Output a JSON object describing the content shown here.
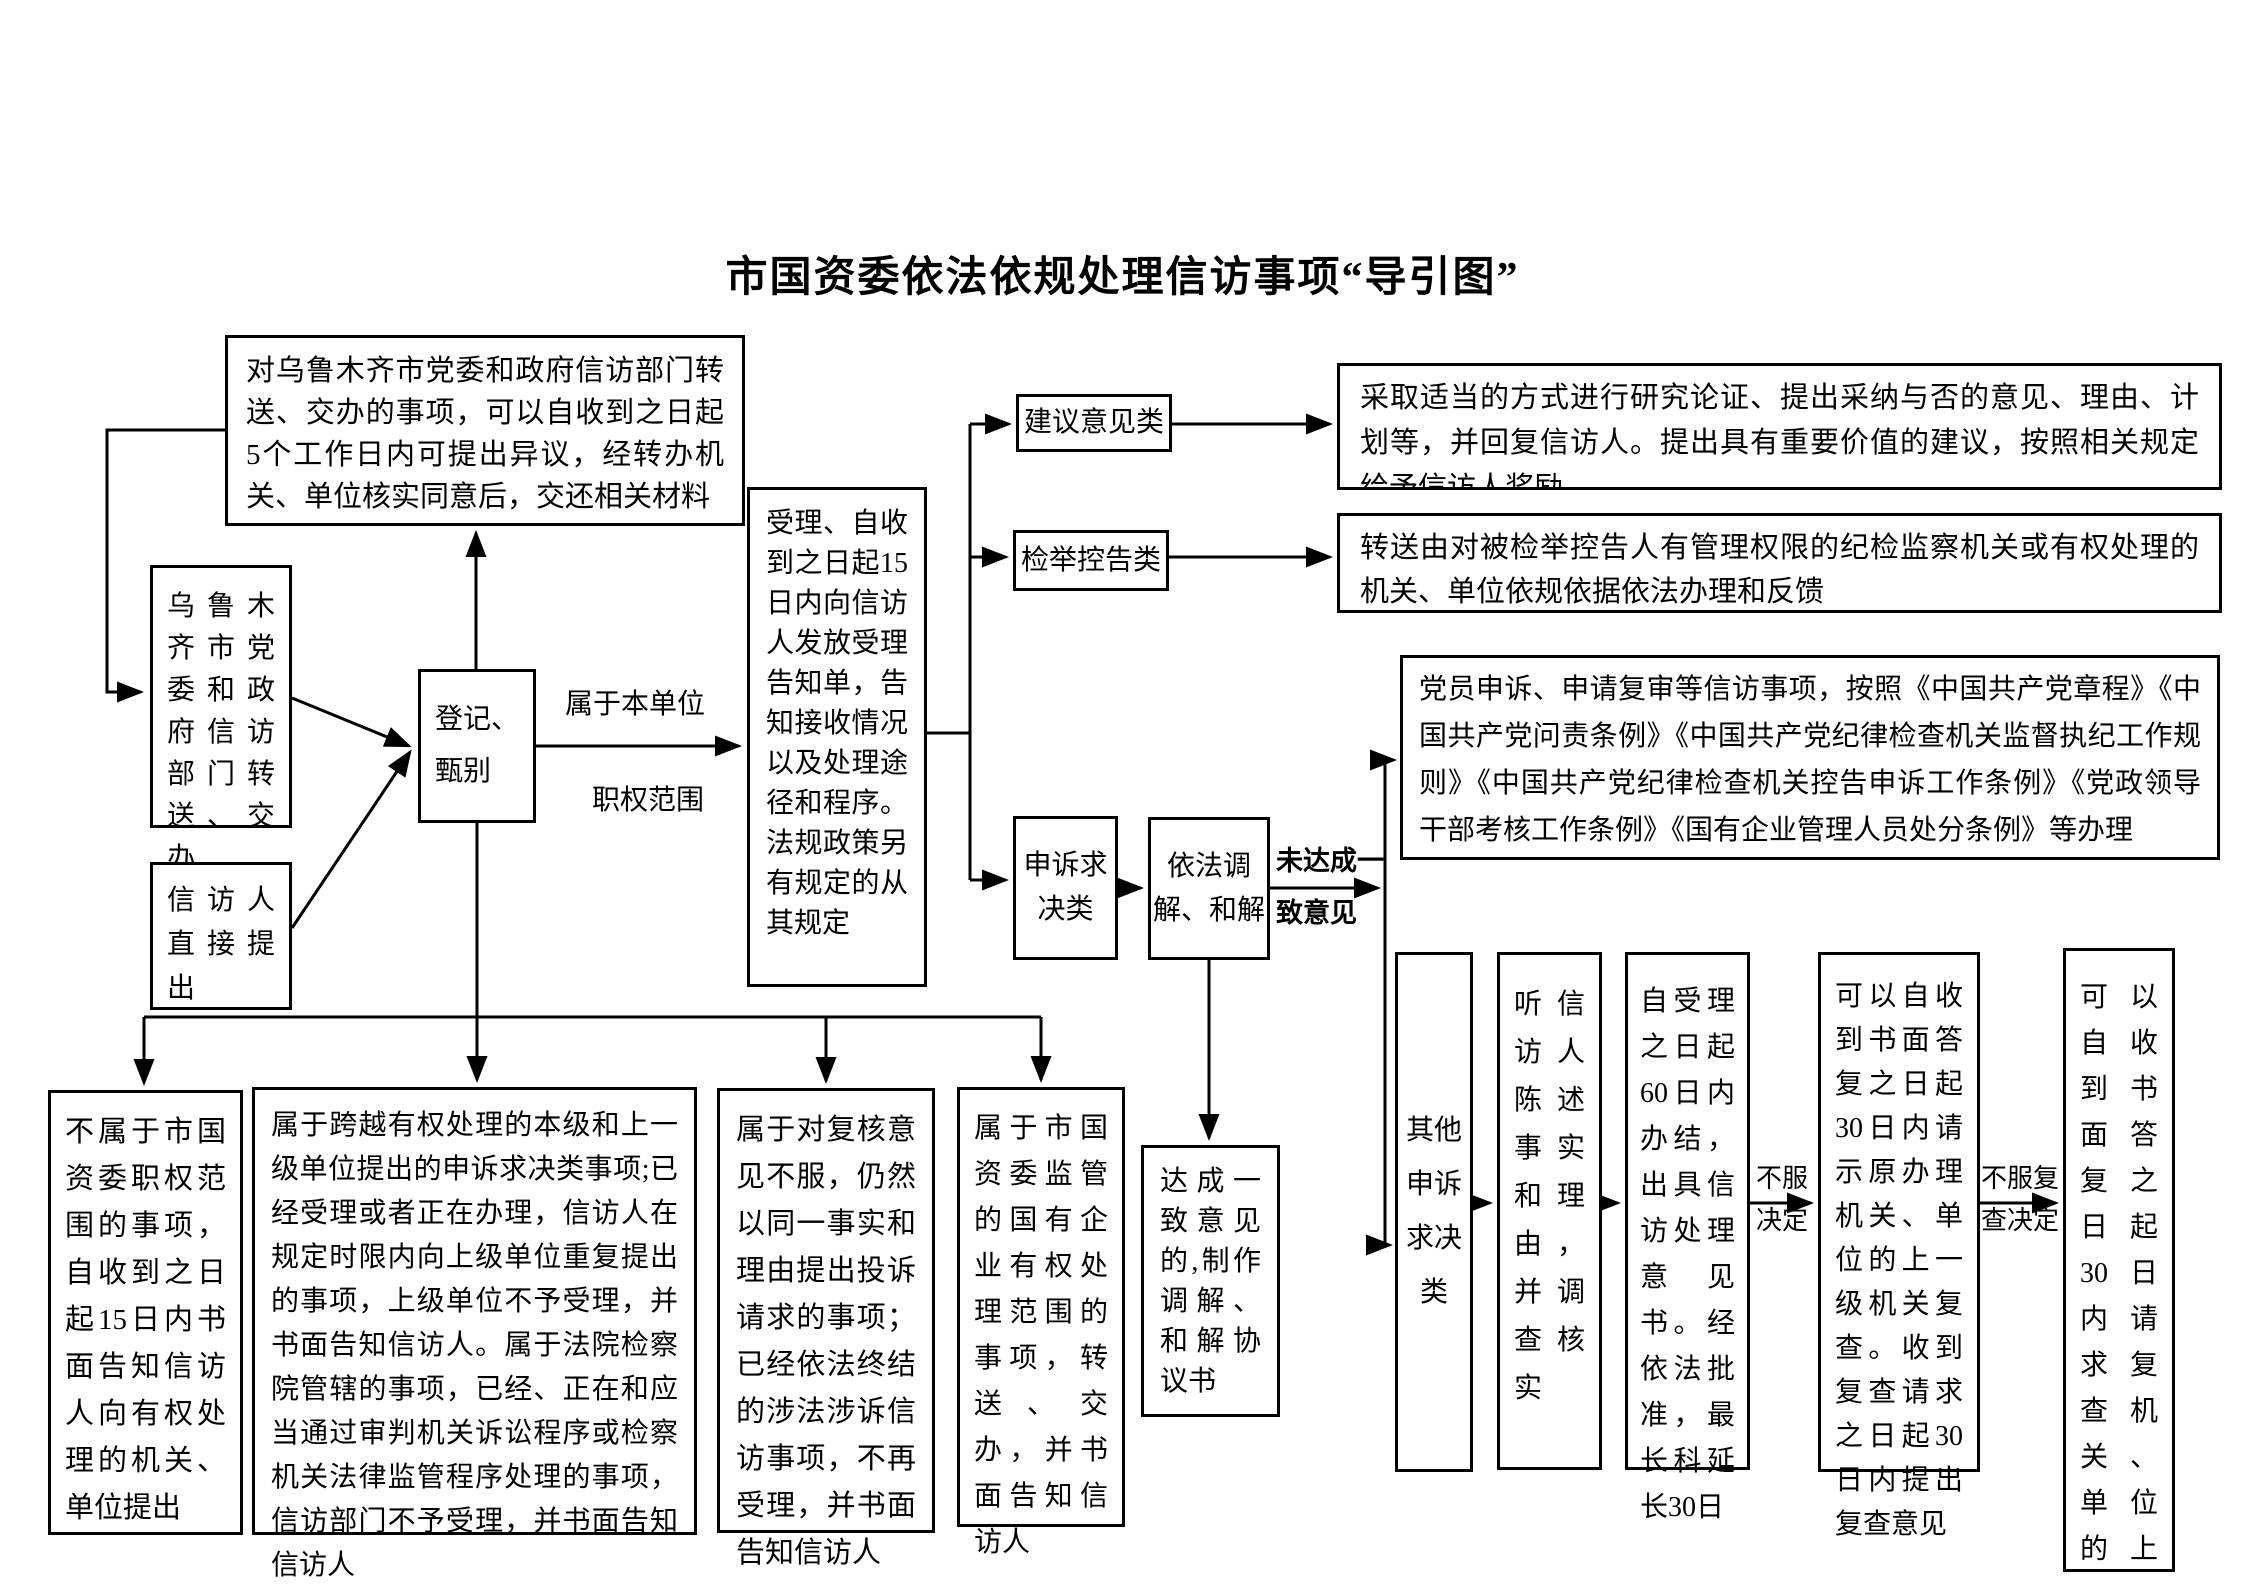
{
  "title": "市国资委依法依规处理信访事项“导引图”",
  "boxes": {
    "objection": {
      "text": "对乌鲁木齐市党委和政府信访部门转送、交办的事项，可以自收到之日起5个工作日内可提出异议，经转办机关、单位核实同意后，交还相关材料"
    },
    "source_gov": {
      "text": "乌鲁木齐市党委和政府信访部门转送、交办"
    },
    "source_direct": {
      "text": "信访人直接提出"
    },
    "register": {
      "text": "登记、甄别"
    },
    "accept": {
      "text": "受理、自收到之日起15日内向信访人发放受理告知单，告知接收情况以及处理途径和程序。法规政策另有规定的从其规定"
    },
    "suggestion": {
      "text": "建议意见类"
    },
    "accusation": {
      "text": "检举控告类"
    },
    "suggestion_handle": {
      "text": "采取适当的方式进行研究论证、提出采纳与否的意见、理由、计划等，并回复信访人。提出具有重要价值的建议，按照相关规定给予信访人奖励"
    },
    "accusation_handle": {
      "text": "转送由对被检举控告人有管理权限的纪检监察机关或有权处理的机关、单位依规依据依法办理和反馈"
    },
    "party_rules": {
      "text": "党员申诉、申请复审等信访事项，按照《中国共产党章程》《中国共产党问责条例》《中国共产党纪律检查机关监督执纪工作规则》《中国共产党纪律检查机关控告申诉工作条例》《党政领导干部考核工作条例》《国有企业管理人员处分条例》等办理"
    },
    "appeal": {
      "text": "申诉求决类"
    },
    "mediation": {
      "text": "依法调解、和解"
    },
    "agreement": {
      "text": "达成一致意见的,制作调解、和解协议书"
    },
    "not_jurisdiction": {
      "text": "不属于市国资委职权范围的事项，自收到之日起15日内书面告知信访人向有权处理的机关、单位提出"
    },
    "cross_level": {
      "text": "属于跨越有权处理的本级和上一级单位提出的申诉求决类事项;已经受理或者正在办理，信访人在规定时限内向上级单位重复提出的事项，上级单位不予受理，并书面告知信访人。属于法院检察院管辖的事项，已经、正在和应当通过审判机关诉讼程序或检察机关法律监管程序处理的事项，信访部门不予受理，并书面告知信访人"
    },
    "review_refuse": {
      "text": "属于对复核意见不服，仍然以同一事实和理由提出投诉请求的事项；已经依法终结的涉法涉诉信访事项，不再受理，并书面告知信访人"
    },
    "soe_scope": {
      "text": "属于市国资委监管的国有企业有权处理范围的事项，转送、交办，并书面告知信访人"
    },
    "other_appeal": {
      "text": "其他申诉求决类"
    },
    "hear_statement": {
      "text": "听信访人陈述事实和理由，并调查核实"
    },
    "handle_60": {
      "text": "自受理之日起60日内办结，出具信访处理意见书。经依法批准，最长科延长30日"
    },
    "recheck": {
      "text": "可以自收到书面答复之日起30日内请示原办理机关、单位的上一级机关复查。收到复查请求之日起30日内提出复查意见"
    },
    "final_review": {
      "text": "可以自收到书面答复之日起30日内请求复查机关、单位的上一级"
    }
  },
  "labels": {
    "within_scope_1": "属于本单位",
    "within_scope_2": "职权范围",
    "no_agreement": "未达成一致意见",
    "refuse_decision": "不服决定",
    "refuse_recheck": "不服复查决定"
  },
  "colors": {
    "line": "#000000",
    "background": "#ffffff",
    "text": "#000000"
  }
}
